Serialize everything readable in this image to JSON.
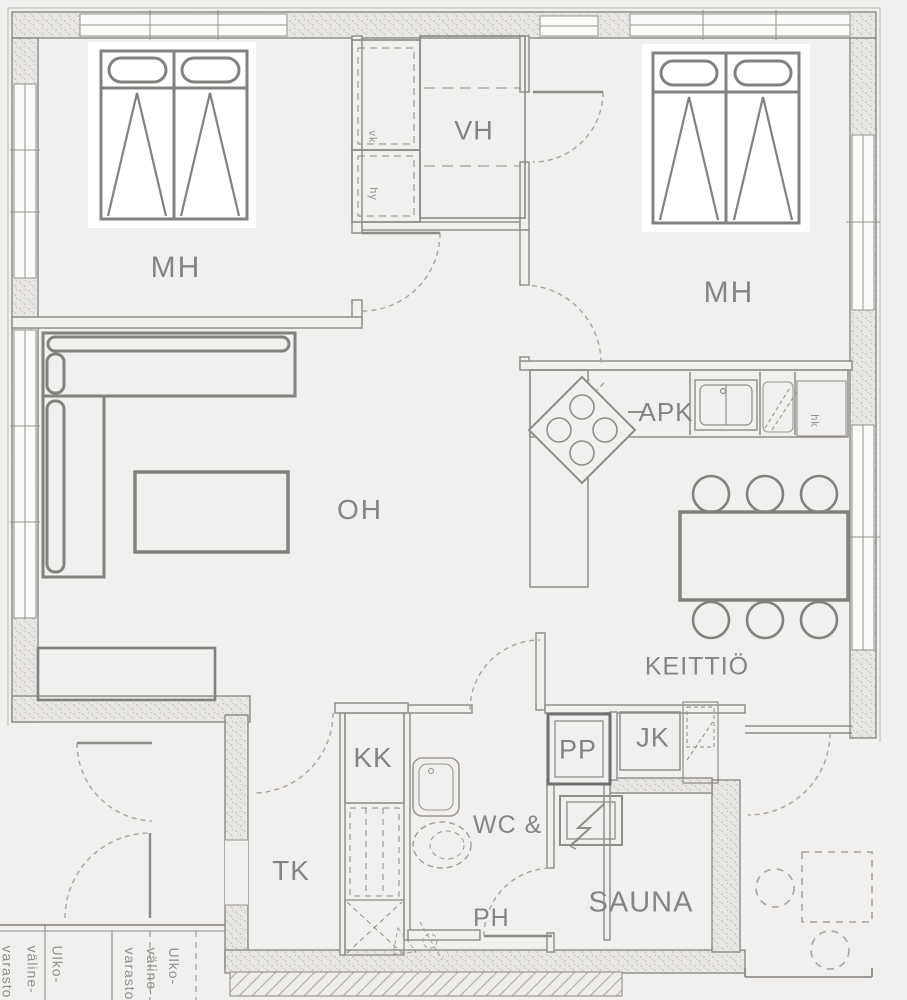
{
  "plan": {
    "title": "Apartment floor plan",
    "rooms": {
      "mh_left": "MH",
      "vh": "VH",
      "mh_right": "MH",
      "oh": "OH",
      "keittio": "KEITTIÖ",
      "kk": "KK",
      "wc_line1": "WC &",
      "wc_line2": "PH",
      "tk": "TK",
      "sauna": "SAUNA"
    },
    "appliances": {
      "apk": "APK",
      "pp": "PP",
      "jk": "JK",
      "hk": "hk",
      "vk": "vk",
      "hy": "hy"
    },
    "storage": {
      "word1": "Ulko-",
      "word2": "väline-",
      "word3": "varasto"
    },
    "colors": {
      "background": "#f1f0ee",
      "wall_fill": "#e9e7e3",
      "line": "#8b8a86",
      "dash": "#a9a6a0",
      "label": "#848484",
      "bed_fill": "#ffffff",
      "dark": "#6f6f6f",
      "window": "#fafaf8"
    }
  }
}
